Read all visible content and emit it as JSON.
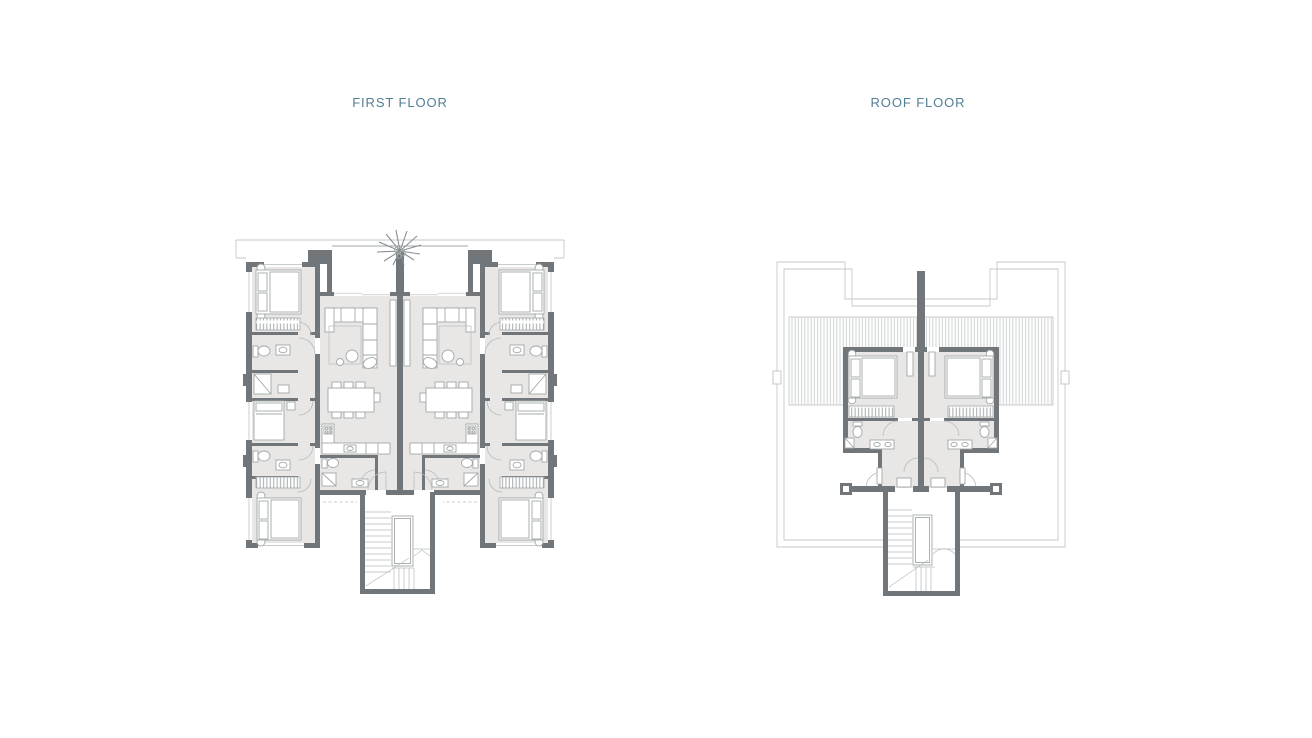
{
  "canvas": {
    "width": 1312,
    "height": 738,
    "background": "#ffffff"
  },
  "plans": [
    {
      "key": "first-floor",
      "title": "FIRST FLOOR"
    },
    {
      "key": "roof-floor",
      "title": "ROOF FLOOR"
    }
  ],
  "colors": {
    "title_text": "#527f96",
    "wall": "#70767a",
    "floor_fill": "#e8e7e5",
    "furniture_line": "#a3a8aa",
    "detail_line": "#b6babc",
    "outline_line": "#c6c9ca"
  },
  "icons": {
    "palm_tree": "palm-tree-icon"
  },
  "features": {
    "first_floor": [
      "front-terrace-with-palm-tree",
      "two-mirrored-units",
      "corner-bedrooms",
      "living-rooms",
      "dining-sets",
      "kitchens",
      "bathrooms",
      "central-staircase"
    ],
    "roof_floor": [
      "roof-terrace-outline",
      "pergola-slats",
      "two-mirrored-bedrooms",
      "bathrooms",
      "central-staircase"
    ]
  }
}
